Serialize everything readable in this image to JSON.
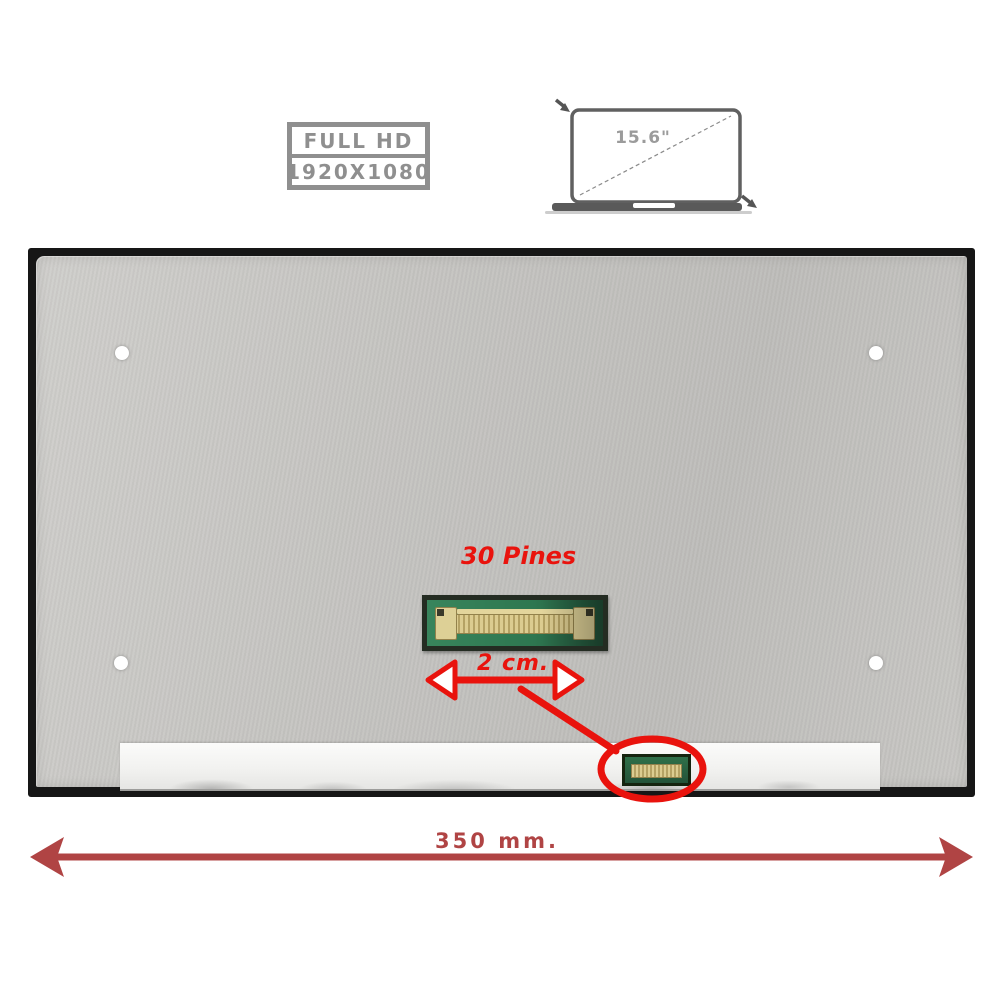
{
  "badge": {
    "line1": "FULL HD",
    "line2": "1920X1080",
    "border_color": "#8f8f8f",
    "text_color": "#8f8f8f"
  },
  "laptop_diagram": {
    "screen_size_label": "15.6\"",
    "outline_color": "#606060",
    "base_color": "#5a5a5a",
    "label_color": "#9b9b9b"
  },
  "panel": {
    "frame_color": "#161616",
    "surface_color": "#c6c5c2",
    "foil_color": "#f4f4f3",
    "screw_hole_color": "#ffffff",
    "screw_hole_count": 4
  },
  "connector_inset": {
    "label": "30 Pines",
    "pcb_color": "#2e7750",
    "pin_color": "#dccc90",
    "frame_color": "#242c22"
  },
  "width_callout": {
    "label": "2 cm.",
    "color": "#e9130d"
  },
  "circle_callout": {
    "color": "#e9130d"
  },
  "panel_width_callout": {
    "label": "350 mm.",
    "color": "#b04444"
  }
}
